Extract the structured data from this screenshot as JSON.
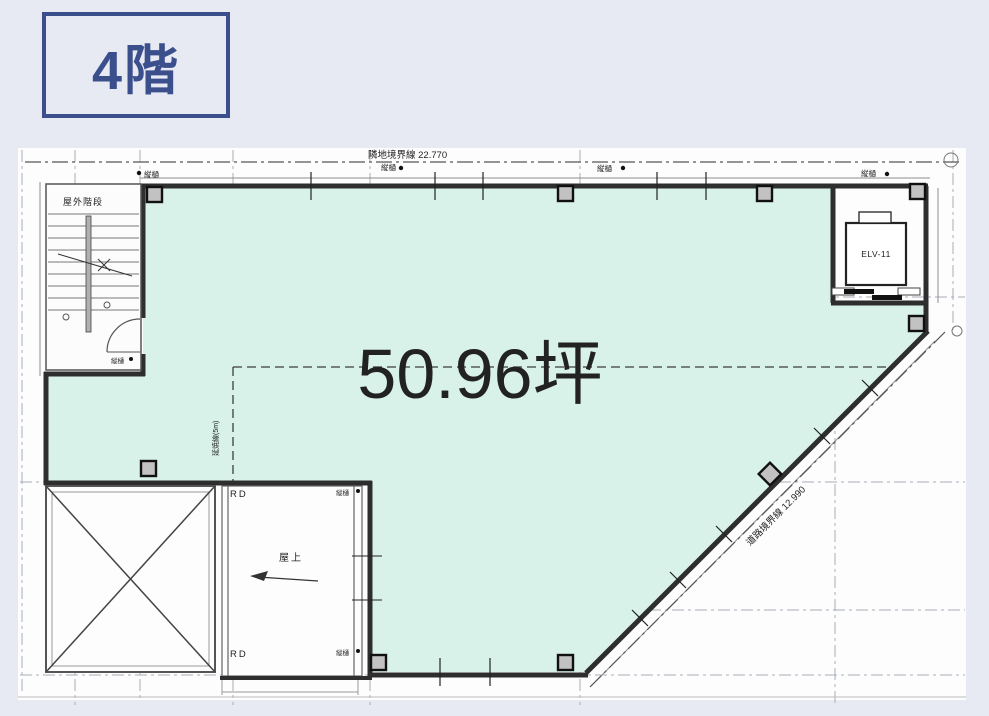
{
  "floor_label": "4階",
  "area_label": "50.96坪",
  "plan": {
    "boundary_top": "隣地境界線 22.770",
    "boundary_road": "道路境界線 12.990",
    "stairs_label": "屋外階段",
    "elevator_label": "ELV-11",
    "roof_label": "屋上",
    "roof_drain_label": "RD",
    "downspout_label": "縦樋",
    "fire_line_label": "延焼線(5m)",
    "colors": {
      "background": "#e7e9f3",
      "floor_fill": "#d8f2e9",
      "accent": "#35518e",
      "line": "#2e2e2e"
    }
  }
}
